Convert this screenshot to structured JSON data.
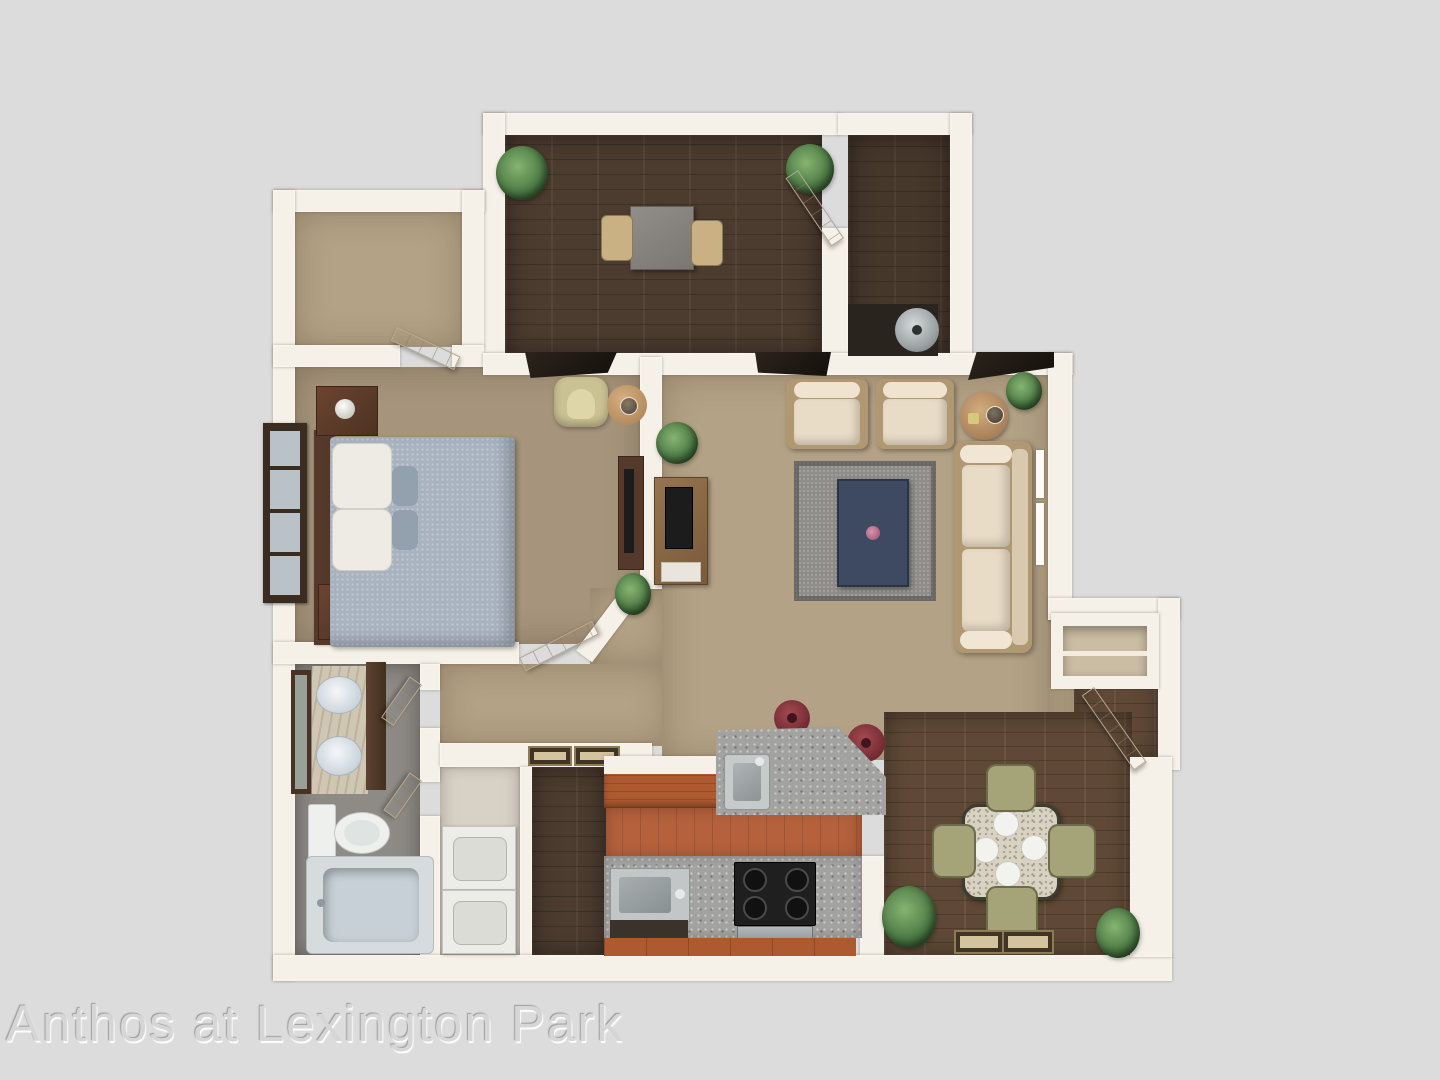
{
  "watermark": {
    "text": "Anthos at Lexington Park"
  },
  "colors": {
    "bg": "#dcdcdc",
    "wall": "#f6f1e8",
    "carpet": "#b3a286",
    "carpetDark": "#a6957c",
    "woodDark": "#4c3c2f",
    "woodDining": "#5f4936",
    "terracotta": "#b4613c",
    "cabinet": "#ad5a31",
    "granite": "#a2a2a0",
    "bathFloor": "#8e8a85",
    "laundryFloor": "#d8d1c5",
    "marble": "#cfc6b4",
    "tub": "#c6d0d6",
    "bed": "#a9b3c0",
    "pillow": "#edebe4",
    "sofa": "#e9dcc6",
    "sofaTrim": "#b09873",
    "rug": "#8f8d89",
    "coffeeTable": "#3d4a61",
    "chairGreen": "#a4a478",
    "stool": "#7c2f38",
    "plant": "#4c7a44",
    "desk": "#87837e",
    "furnDark": "#55392b",
    "tv": "#1c1c1c",
    "heater": "#9aa1a3",
    "watermarkColor": "#d6d6d6"
  }
}
